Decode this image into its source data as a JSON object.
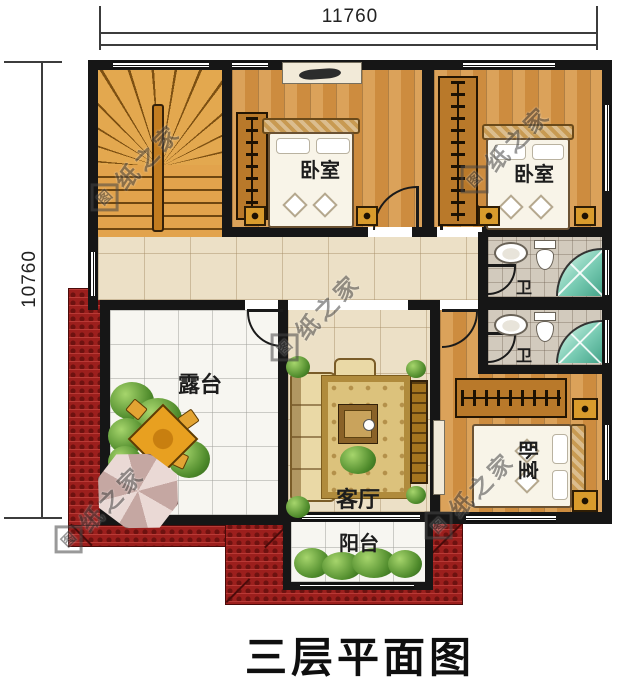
{
  "title": "三层平面图",
  "dimensions": {
    "top": "11760",
    "left": "10760"
  },
  "watermark": {
    "logo": "图",
    "text": "纸之家"
  },
  "labels": {
    "bedroom1": "卧室",
    "bedroom2": "卧室",
    "bedroom3": "卧室",
    "terrace": "露台",
    "living_room": "客厅",
    "balcony": "阳台",
    "bath1": "卫",
    "bath2": "卫"
  },
  "colors": {
    "wall": "#161616",
    "roof_red": "#9c1f1d",
    "wood_floor": "#cd8c3f",
    "hall_tile": "#ece0c6",
    "marble": "#f7f6f1",
    "bath_tile": "#d2cabd",
    "shower_teal": "#7accb4",
    "rug_gold": "#dcc27c"
  }
}
